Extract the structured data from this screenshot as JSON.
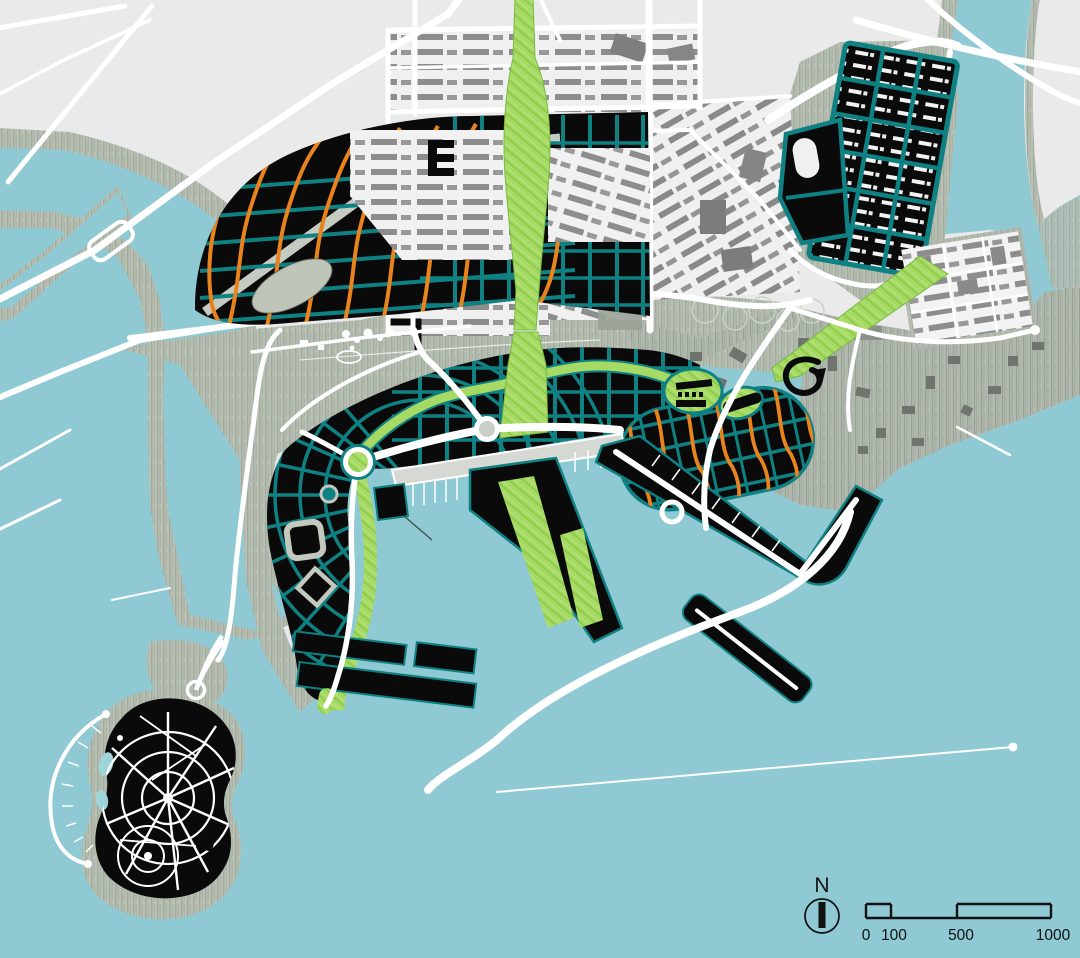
{
  "map": {
    "north_indicator": {
      "label": "N"
    },
    "scale_bar": {
      "tick_labels": [
        "0",
        "100",
        "500",
        "1000"
      ]
    },
    "palette": {
      "water": "#8ec9d4",
      "land": "#eaeaea",
      "shore_texture": "#b9c0b4",
      "district_fill": "#0a0a0a",
      "street_grid_teal": "#0f8183",
      "street_grid_orange": "#e8831d",
      "park_green": "#a6da64",
      "existing_buildings": "#8d8d8d",
      "road": "#ffffff"
    }
  }
}
